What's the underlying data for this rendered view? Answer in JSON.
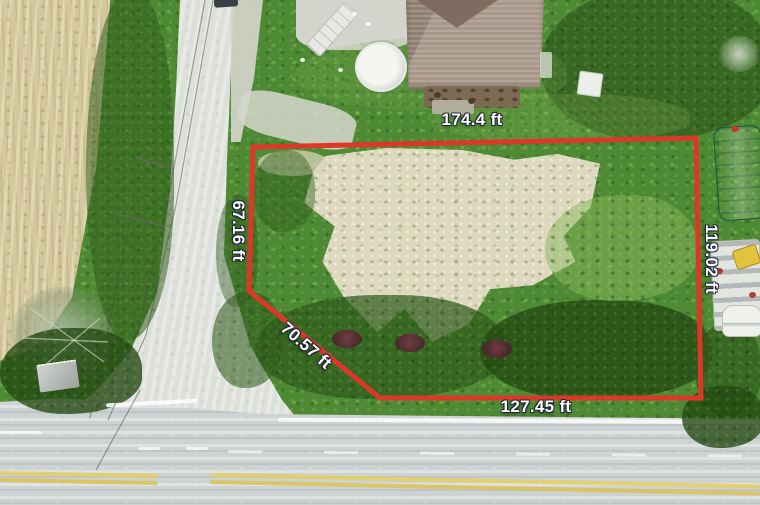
{
  "measurements": {
    "top": "174.4 ft",
    "left": "67.16 ft",
    "diagonal": "70.57 ft",
    "bottom": "127.45 ft",
    "right": "119.02 ft"
  },
  "colors": {
    "boundary": "#dc3828",
    "label_text": "#ffffff",
    "main_road_asphalt": "#cdd2d3",
    "side_road_asphalt": "#dde0da",
    "field_tan": "#d5c99c",
    "sand_clearing": "#ded8bf",
    "vegetation_green": "#4e8a33",
    "house_roof": "#a8988a",
    "pool_white": "#f4f6f2",
    "quonset_teal": "#2ba183",
    "centerline_yellow": "#e5ce60"
  }
}
